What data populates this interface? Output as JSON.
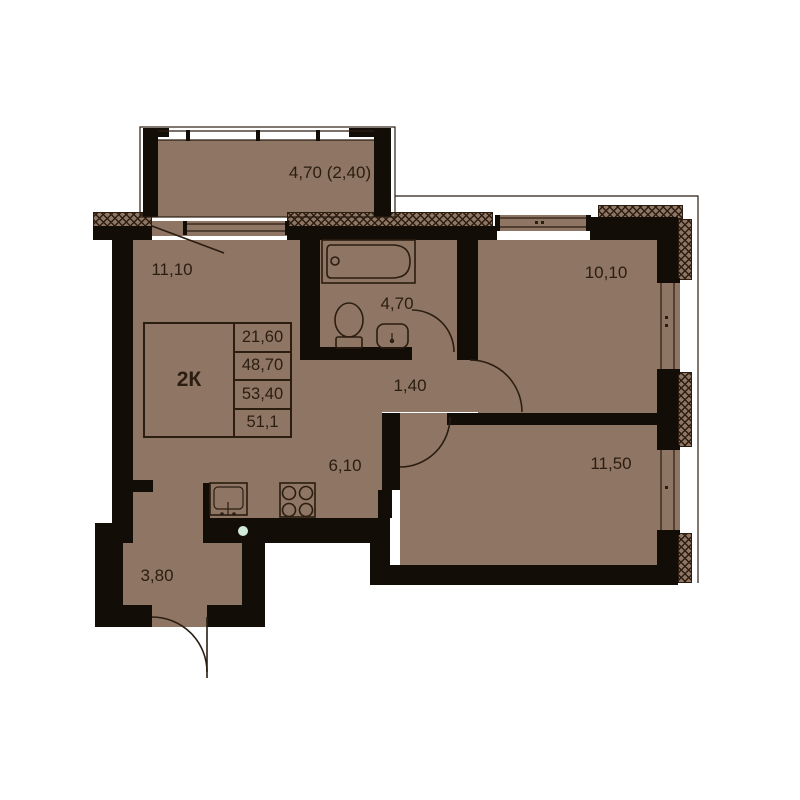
{
  "apartment": {
    "type": "2К",
    "area_rows": [
      "21,60",
      "48,70",
      "53,40",
      "51,1"
    ]
  },
  "room_labels": {
    "balcony": "4,70 (2,40)",
    "living_room": "11,10",
    "bathroom": "4,70",
    "bedroom_top": "10,10",
    "hallway": "1,40",
    "bedroom_bottom": "11,50",
    "kitchen": "6,10",
    "entry": "3,80"
  },
  "colors": {
    "floor": "#8e7564",
    "wall": "#130d08",
    "line": "#2b1d10",
    "background": "#ffffff",
    "dot": "#d2ead8"
  }
}
